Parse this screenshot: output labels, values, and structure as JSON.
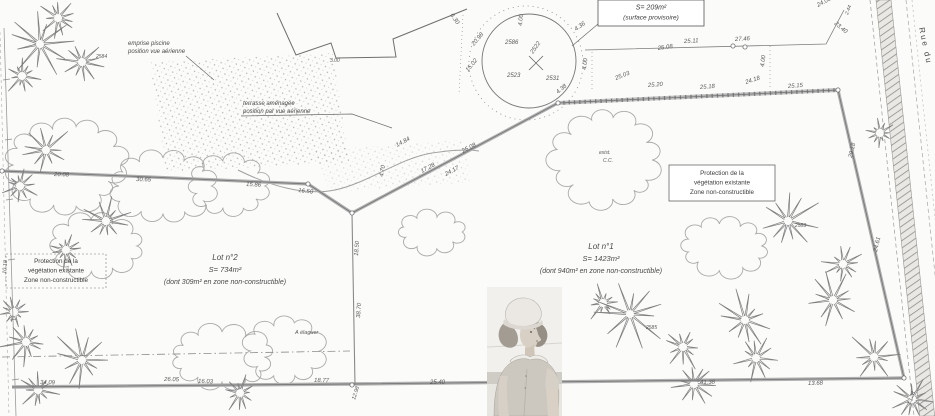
{
  "labels": {
    "surface": [
      "S= 209m²",
      "(surface provisoire)"
    ],
    "pool": [
      "emprise piscine",
      "position vue aérienne"
    ],
    "terrace": [
      "terrasse aménagée",
      "position par vue aérienne"
    ],
    "protection_left": [
      "Protection de la",
      "végétation existante",
      "Zone non-constructible"
    ],
    "protection_right": [
      "Protection de la",
      "végétation existante",
      "Zone non-constructible"
    ],
    "lot2": [
      "Lot n°2",
      "S= 734m²",
      "(dont 309m² en zone non-constructible)"
    ],
    "lot1": [
      "Lot n°1",
      "S= 1423m²",
      "(dont 940m² en zone non-constructible)"
    ],
    "street": "Rue du"
  },
  "map": {
    "dimensions": [
      {
        "t": "27.46",
        "x": 735,
        "y": 41,
        "r": -3
      },
      {
        "t": "25.11",
        "x": 684,
        "y": 43,
        "r": -3
      },
      {
        "t": "25.08",
        "x": 658,
        "y": 50,
        "r": -8
      },
      {
        "t": "24.05",
        "x": 818,
        "y": 7,
        "r": -28
      },
      {
        "t": "23.40",
        "x": 834,
        "y": 24,
        "r": 40
      },
      {
        "t": "2.44",
        "x": 848,
        "y": 15,
        "r": -70,
        "s": 5
      },
      {
        "t": "4.00",
        "x": 586,
        "y": 70,
        "r": -83
      },
      {
        "t": "4.00",
        "x": 764,
        "y": 67,
        "r": -83
      },
      {
        "t": "25.03",
        "x": 616,
        "y": 80,
        "r": -22
      },
      {
        "t": "25.20",
        "x": 648,
        "y": 87,
        "r": -4
      },
      {
        "t": "25.18",
        "x": 700,
        "y": 89,
        "r": -4
      },
      {
        "t": "24.18",
        "x": 746,
        "y": 84,
        "r": -18
      },
      {
        "t": "25.15",
        "x": 788,
        "y": 88,
        "r": -4
      },
      {
        "t": "29.18",
        "x": 852,
        "y": 158,
        "r": -77
      },
      {
        "t": "24.61",
        "x": 877,
        "y": 252,
        "r": -77
      },
      {
        "t": "2586",
        "x": 505,
        "y": 44,
        "r": 0
      },
      {
        "t": "2522",
        "x": 533,
        "y": 54,
        "r": -55
      },
      {
        "t": "2531",
        "x": 546,
        "y": 80,
        "r": 0
      },
      {
        "t": "2523",
        "x": 507,
        "y": 77,
        "r": 0
      },
      {
        "t": "4.36",
        "x": 576,
        "y": 31,
        "r": -35
      },
      {
        "t": "4.00",
        "x": 522,
        "y": 26,
        "r": -85
      },
      {
        "t": "6.30",
        "x": 450,
        "y": 15,
        "r": 55
      },
      {
        "t": "20.98",
        "x": 474,
        "y": 46,
        "r": -50
      },
      {
        "t": "15.02",
        "x": 468,
        "y": 72,
        "r": -50
      },
      {
        "t": "4.38",
        "x": 558,
        "y": 94,
        "r": -40
      },
      {
        "t": "14.84",
        "x": 397,
        "y": 147,
        "r": -28
      },
      {
        "t": "25.08",
        "x": 463,
        "y": 153,
        "r": -28
      },
      {
        "t": "17.28",
        "x": 422,
        "y": 173,
        "r": -28
      },
      {
        "t": "24.17",
        "x": 446,
        "y": 176,
        "r": -28
      },
      {
        "t": "4.70",
        "x": 383,
        "y": 177,
        "r": -80
      },
      {
        "t": "20.08",
        "x": 54,
        "y": 176,
        "r": 2
      },
      {
        "t": "30.65",
        "x": 136,
        "y": 181,
        "r": 2
      },
      {
        "t": "15.86",
        "x": 246,
        "y": 186,
        "r": 3
      },
      {
        "t": "16.50",
        "x": 298,
        "y": 192,
        "r": 6
      },
      {
        "t": "18.50",
        "x": 358,
        "y": 256,
        "r": -86
      },
      {
        "t": "38.70",
        "x": 360,
        "y": 318,
        "r": -86
      },
      {
        "t": "34.09",
        "x": 40,
        "y": 384,
        "r": 1
      },
      {
        "t": "26.05",
        "x": 164,
        "y": 381,
        "r": 1
      },
      {
        "t": "16.03",
        "x": 198,
        "y": 383,
        "r": 1
      },
      {
        "t": "18.77",
        "x": 314,
        "y": 382,
        "r": 1
      },
      {
        "t": "25.40",
        "x": 430,
        "y": 384,
        "r": 0
      },
      {
        "t": "41.38",
        "x": 700,
        "y": 384,
        "r": -1
      },
      {
        "t": "13.68",
        "x": 808,
        "y": 385,
        "r": -1
      },
      {
        "t": "12.98",
        "x": 355,
        "y": 400,
        "r": -72,
        "s": 5.5
      },
      {
        "t": "13.28",
        "x": 910,
        "y": 405,
        "r": -68,
        "s": 5.5
      },
      {
        "t": "10.18",
        "x": 6,
        "y": 274,
        "r": -85,
        "s": 5.5
      },
      {
        "t": "2584",
        "x": 96,
        "y": 58,
        "r": 0,
        "s": 5
      },
      {
        "t": "2585",
        "x": 646,
        "y": 329,
        "r": 0,
        "s": 5
      },
      {
        "t": "2583",
        "x": 795,
        "y": 227,
        "r": 0,
        "s": 5
      },
      {
        "t": "exist.",
        "x": 599,
        "y": 154,
        "r": 0,
        "s": 5
      },
      {
        "t": "C.C.",
        "x": 603,
        "y": 162,
        "r": 0,
        "s": 5
      },
      {
        "t": "A élaguer",
        "x": 295,
        "y": 334,
        "r": 0,
        "s": 5.5
      },
      {
        "t": "3.00",
        "x": 330,
        "y": 62,
        "r": 0,
        "s": 5
      }
    ],
    "trees": [
      [
        40,
        44,
        1.2,
        0
      ],
      [
        82,
        62,
        0.9,
        20
      ],
      [
        22,
        76,
        0.7,
        40
      ],
      [
        58,
        18,
        0.8,
        10
      ],
      [
        46,
        150,
        1.0,
        0
      ],
      [
        20,
        186,
        0.7,
        30
      ],
      [
        106,
        221,
        0.9,
        15
      ],
      [
        66,
        250,
        0.7,
        0
      ],
      [
        26,
        342,
        0.95,
        0
      ],
      [
        82,
        360,
        1.15,
        25
      ],
      [
        38,
        390,
        0.8,
        10
      ],
      [
        14,
        312,
        0.6,
        0
      ],
      [
        603,
        303,
        0.7,
        0
      ],
      [
        630,
        314,
        1.35,
        12
      ],
      [
        683,
        347,
        0.9,
        30
      ],
      [
        694,
        384,
        0.8,
        0
      ],
      [
        745,
        320,
        1.1,
        18
      ],
      [
        756,
        358,
        0.85,
        40
      ],
      [
        833,
        300,
        1.0,
        0
      ],
      [
        874,
        357,
        1.0,
        22
      ],
      [
        912,
        399,
        0.8,
        0
      ],
      [
        788,
        221,
        1.3,
        8
      ],
      [
        843,
        264,
        0.75,
        30
      ],
      [
        880,
        133,
        0.55,
        0
      ],
      [
        240,
        393,
        0.7,
        0
      ]
    ],
    "clouds": [
      [
        65,
        165,
        52,
        40,
        14
      ],
      [
        163,
        186,
        46,
        28,
        12
      ],
      [
        228,
        186,
        36,
        24,
        11
      ],
      [
        97,
        246,
        40,
        25,
        11
      ],
      [
        607,
        160,
        47,
        41,
        13
      ],
      [
        725,
        246,
        39,
        23,
        11
      ],
      [
        222,
        357,
        47,
        25,
        12
      ],
      [
        284,
        351,
        33,
        28,
        10
      ],
      [
        432,
        232,
        29,
        16,
        9
      ]
    ],
    "markers": [
      [
        2,
        171
      ],
      [
        308,
        184
      ],
      [
        352,
        213
      ],
      [
        558,
        103
      ],
      [
        838,
        90
      ],
      [
        904,
        378
      ],
      [
        352,
        385
      ],
      [
        733,
        46
      ],
      [
        745,
        47
      ]
    ]
  }
}
